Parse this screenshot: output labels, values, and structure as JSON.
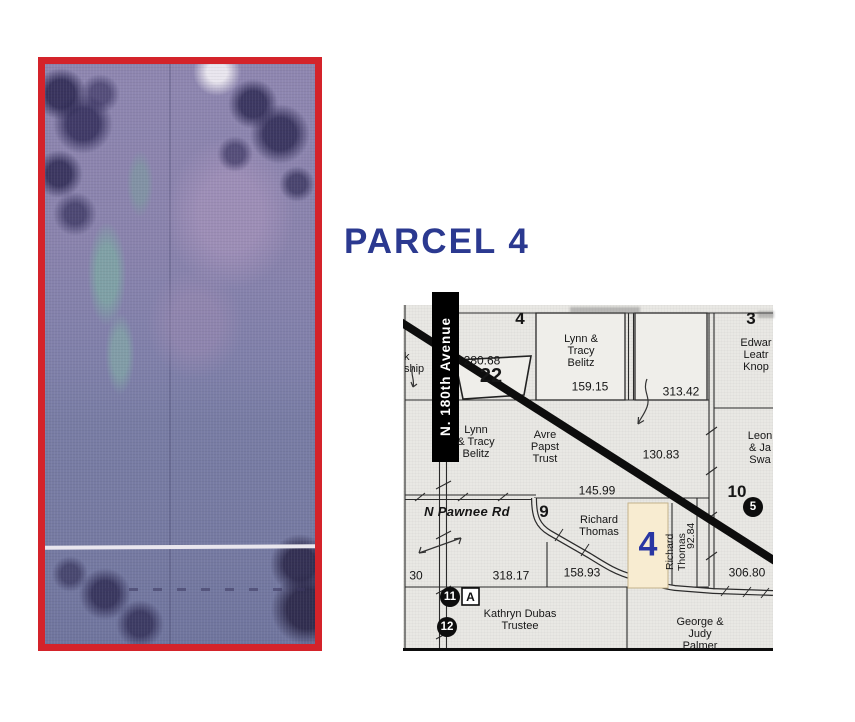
{
  "title": "PARCEL 4",
  "colors": {
    "title_blue": "#2b3990",
    "photo_border_red": "#d4232a",
    "highlight_parcel_fill": "#f8ecd1",
    "highlight_parcel_number_blue": "#2936a3"
  },
  "map": {
    "roads": {
      "avenue": "N. 180th Avenue",
      "pawnee": "N Pawnee Rd"
    },
    "sections": {
      "four": "4",
      "three": "3",
      "nine": "9",
      "ten": "10",
      "twentytwo": "22"
    },
    "parcel_highlight_number": "4",
    "measurements": {
      "m280": "280.68",
      "m159": "159.15",
      "m313": "313.42",
      "m130": "130.83",
      "m145": "145.99",
      "m318": "318.17",
      "m158": "158.93",
      "m306": "306.80",
      "m92": "92.84",
      "m30": "30"
    },
    "owners": {
      "belitz_north": "Lynn &\nTracy\nBelitz",
      "belitz_west": "Lynn\n& Tracy\nBelitz",
      "papst": "Avre\nPapst\nTrust",
      "thomas": "Richard\nThomas",
      "thomas_vertical": "Richard\nThomas",
      "knopik_cut": "Edwar\nLeatr\nKnop",
      "swanson_cut": "Leon\n& Ja\nSwa",
      "dubas": "Kathryn Dubas\nTrustee",
      "palmer": "George & Judy\nPalmer",
      "township_cut": "k\nship"
    },
    "markers": {
      "five": "5",
      "eleven": "11",
      "eleven_a": "A",
      "twelve": "12"
    }
  }
}
